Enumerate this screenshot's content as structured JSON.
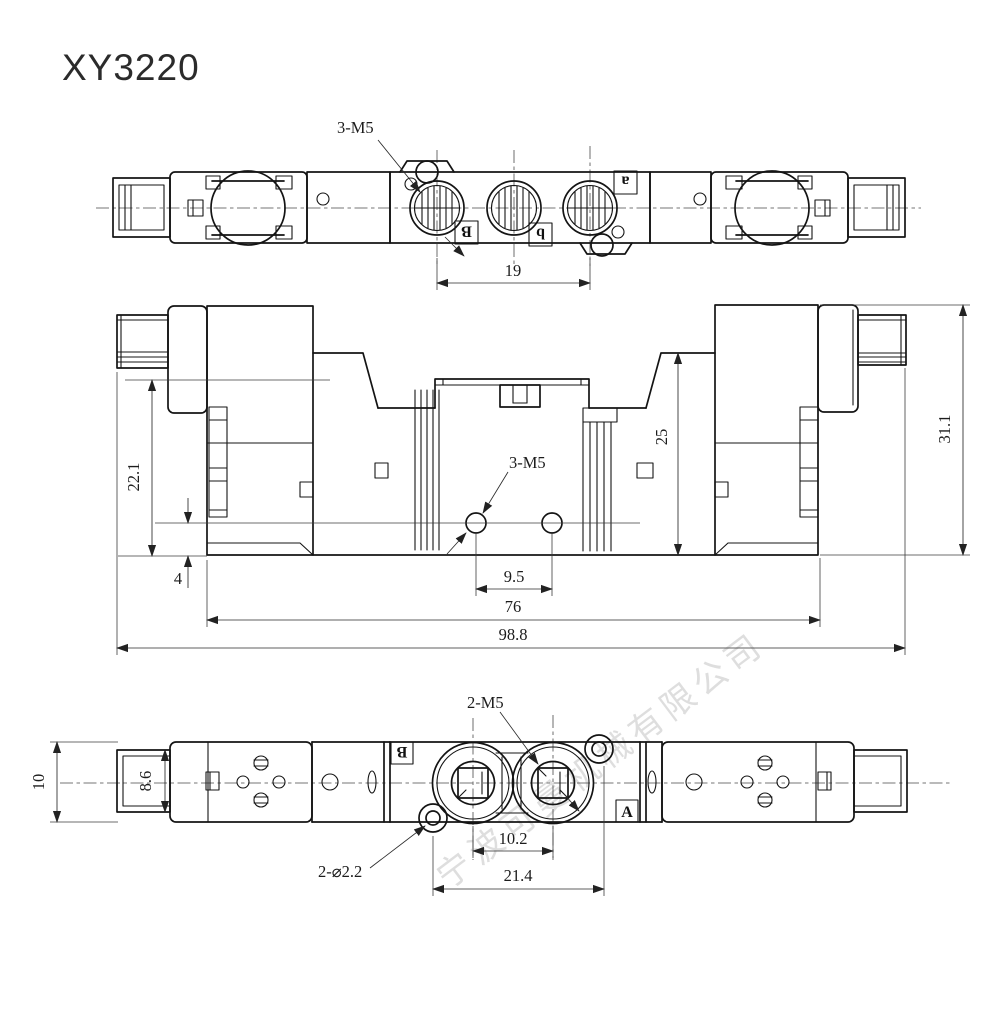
{
  "title": "XY3220",
  "watermark": "宁波可曼机械有限公司",
  "views": {
    "top": {
      "callout_thread": "3-M5",
      "dim_port_spacing": "19",
      "label_a": "a",
      "label_B": "B",
      "label_b": "b"
    },
    "front": {
      "callout_thread": "3-M5",
      "dim_solenoid_height": "22.1",
      "dim_hole_offset": "4",
      "dim_hole_spacing": "9.5",
      "dim_body_length": "76",
      "dim_overall_length": "98.8",
      "dim_center_height": "25",
      "dim_overall_height": "31.1"
    },
    "bottom": {
      "callout_thread": "2-M5",
      "callout_hole": "2-⌀2.2",
      "dim_overall_height": "10",
      "dim_connector_height": "8.6",
      "dim_port_spacing": "10.2",
      "dim_mount_spacing": "21.4",
      "label_B": "B",
      "label_A": "A"
    }
  }
}
